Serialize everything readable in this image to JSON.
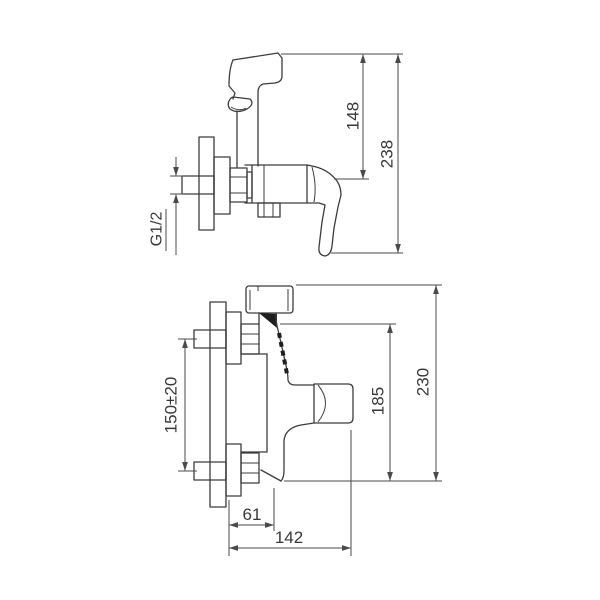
{
  "drawing": {
    "kind": "technical line drawing, two orthographic views of a wall-mounted shower mixer with hand sprayer",
    "background_color": "#ffffff",
    "line_color": "#3c3c3c",
    "dimension_line_color": "#4a4a4a",
    "text_color": "#383838",
    "views": {
      "front": {
        "name": "front-view"
      },
      "side": {
        "name": "side-view"
      }
    }
  },
  "dimensions": {
    "front": {
      "sprayer_height": "148",
      "overall_height": "238",
      "thread_size": "G1/2"
    },
    "side": {
      "inlet_spacing": "150±20",
      "body_height": "185",
      "overall_height": "230",
      "wall_to_body": "61",
      "wall_to_handle": "142"
    }
  }
}
